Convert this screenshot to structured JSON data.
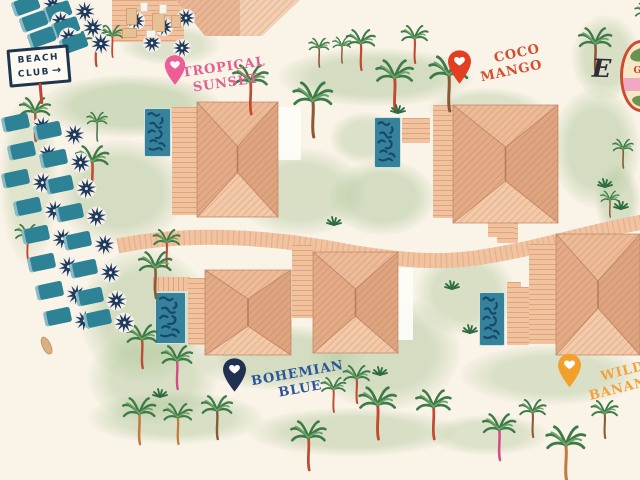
{
  "signs": {
    "beach_club": {
      "line1": "BEACH",
      "line2": "CLUB",
      "arrow": "→"
    },
    "compass_letter": "E"
  },
  "badge": {
    "visible_text": "GY"
  },
  "villas": [
    {
      "id": "tropical-sunset",
      "name": "Tropical Sunset",
      "label_line1": "TROPICAL",
      "label_line2": "SUNSET",
      "label_color": "#e2608f",
      "pin_color": "#ee5d95"
    },
    {
      "id": "coco-mango",
      "name": "Coco Mango",
      "label_line1": "COCO",
      "label_line2": "MANGO",
      "label_color": "#d74c2b",
      "pin_color": "#e33d22"
    },
    {
      "id": "bohemian-blue",
      "name": "Bohemian Blue",
      "label_line1": "BOHEMIAN",
      "label_line2": "BLUE",
      "label_color": "#2c549a",
      "pin_color": "#202f52"
    },
    {
      "id": "wild-banana",
      "name": "Wild Banana",
      "label_line1": "WILD",
      "label_line2": "BANANA",
      "label_color": "#f1a33e",
      "pin_color": "#f39f2c"
    }
  ],
  "colors": {
    "vars": {
      "bg": "#faf3e8",
      "grass": "#aec79a",
      "pool": "#35829a",
      "deck": "#f2c29e",
      "deck-line": "#dba67f",
      "walk": "#f1c3a0",
      "walk-line": "#dca47f",
      "lounger": "#2d8296",
      "parasol": "#1f3a5c",
      "sign-ink": "#1f3650",
      "post": "#c34432",
      "squig": "#17496f",
      "patio": "#fdfcf8"
    },
    "roof": {
      "top": "#edbb98",
      "bottom": "#f4caa8",
      "left": "#e4ab87",
      "right": "#dea580",
      "edge": "#c28a68",
      "ridge": "#b97f5e"
    },
    "trunks": {
      "r": "#c14a30",
      "b": "#8a5a35",
      "o": "#c07c3c",
      "p": "#d64a86",
      "g": "#4d7c4d"
    }
  },
  "map": {
    "blobs": [
      [
        40,
        75,
        180,
        62,
        0.55
      ],
      [
        278,
        48,
        195,
        58,
        0.5
      ],
      [
        428,
        88,
        115,
        42,
        0.4
      ],
      [
        572,
        15,
        68,
        85,
        0.45
      ],
      [
        55,
        140,
        130,
        105,
        0.5
      ],
      [
        235,
        148,
        130,
        88,
        0.45
      ],
      [
        330,
        160,
        105,
        75,
        0.5
      ],
      [
        552,
        88,
        88,
        120,
        0.5
      ],
      [
        595,
        165,
        45,
        70,
        0.45
      ],
      [
        80,
        248,
        130,
        135,
        0.5
      ],
      [
        88,
        330,
        130,
        95,
        0.45
      ],
      [
        195,
        325,
        170,
        65,
        0.5
      ],
      [
        310,
        295,
        150,
        115,
        0.5
      ],
      [
        415,
        250,
        100,
        85,
        0.45
      ],
      [
        460,
        345,
        185,
        60,
        0.42
      ],
      [
        540,
        235,
        100,
        62,
        0.45
      ],
      [
        248,
        408,
        210,
        48,
        0.45
      ],
      [
        88,
        392,
        175,
        52,
        0.45
      ],
      [
        330,
        112,
        70,
        52,
        0.4
      ],
      [
        120,
        25,
        100,
        40,
        0.38
      ],
      [
        0,
        95,
        58,
        170,
        0.35
      ],
      [
        428,
        415,
        120,
        40,
        0.38
      ]
    ],
    "decks": [
      [
        172,
        107,
        25,
        108,
        "h"
      ],
      [
        402,
        118,
        28,
        25,
        "h"
      ],
      [
        433,
        105,
        29,
        113,
        "h"
      ],
      [
        497,
        223,
        21,
        20,
        "h"
      ],
      [
        153,
        277,
        37,
        14,
        "v"
      ],
      [
        188,
        278,
        24,
        67,
        "h"
      ],
      [
        292,
        245,
        21,
        73,
        "h"
      ],
      [
        488,
        222,
        26,
        15,
        "h"
      ],
      [
        507,
        282,
        14,
        12,
        "h"
      ],
      [
        529,
        244,
        30,
        100,
        "h"
      ],
      [
        507,
        287,
        22,
        58,
        "h"
      ],
      [
        112,
        0,
        72,
        42,
        "h"
      ]
    ],
    "patios": [
      [
        278,
        107,
        23,
        53
      ],
      [
        397,
        268,
        16,
        72
      ]
    ],
    "pools": [
      [
        144,
        108,
        27,
        49
      ],
      [
        374,
        117,
        27,
        51
      ],
      [
        155,
        292,
        31,
        52
      ],
      [
        479,
        292,
        26,
        54
      ]
    ],
    "roofs": [
      [
        197,
        102,
        81,
        115
      ],
      [
        453,
        105,
        105,
        118
      ],
      [
        205,
        270,
        86,
        85
      ],
      [
        313,
        252,
        85,
        101
      ],
      [
        556,
        234,
        84,
        121
      ]
    ],
    "palms": [
      [
        80,
        52,
        0.7,
        "r"
      ],
      [
        100,
        46,
        0.55,
        "r"
      ],
      [
        18,
        126,
        0.75,
        "r"
      ],
      [
        86,
        131,
        0.5,
        "g"
      ],
      [
        75,
        176,
        0.8,
        "r"
      ],
      [
        14,
        247,
        0.6,
        "r"
      ],
      [
        232,
        97,
        0.85,
        "r"
      ],
      [
        292,
        118,
        0.95,
        "b"
      ],
      [
        308,
        57,
        0.5,
        "b"
      ],
      [
        332,
        54,
        0.45,
        "b"
      ],
      [
        345,
        56,
        0.7,
        "r"
      ],
      [
        400,
        50,
        0.65,
        "r"
      ],
      [
        375,
        94,
        0.9,
        "r"
      ],
      [
        428,
        92,
        0.95,
        "b"
      ],
      [
        578,
        58,
        0.8,
        "b"
      ],
      [
        634,
        24,
        0.55,
        "b"
      ],
      [
        152,
        254,
        0.65,
        "r"
      ],
      [
        138,
        282,
        0.8,
        "b"
      ],
      [
        125,
        353,
        0.75,
        "r"
      ],
      [
        160,
        374,
        0.75,
        "p"
      ],
      [
        122,
        428,
        0.8,
        "o"
      ],
      [
        162,
        430,
        0.7,
        "o"
      ],
      [
        200,
        424,
        0.75,
        "b"
      ],
      [
        290,
        453,
        0.85,
        "r"
      ],
      [
        320,
        400,
        0.6,
        "r"
      ],
      [
        358,
        421,
        0.9,
        "r"
      ],
      [
        342,
        390,
        0.65,
        "r"
      ],
      [
        415,
        422,
        0.85,
        "r"
      ],
      [
        482,
        444,
        0.8,
        "p"
      ],
      [
        518,
        424,
        0.65,
        "b"
      ],
      [
        545,
        462,
        0.95,
        "o"
      ],
      [
        590,
        425,
        0.65,
        "b"
      ],
      [
        612,
        158,
        0.5,
        "b"
      ],
      [
        600,
        208,
        0.45,
        "b"
      ]
    ],
    "tufts": [
      [
        597,
        178
      ],
      [
        613,
        200
      ],
      [
        444,
        280
      ],
      [
        462,
        324
      ],
      [
        372,
        366
      ],
      [
        152,
        388
      ],
      [
        390,
        104
      ],
      [
        326,
        216
      ]
    ],
    "loungers": [
      [
        12,
        -8,
        -20
      ],
      [
        44,
        -2,
        -20
      ],
      [
        20,
        8,
        -20
      ],
      [
        52,
        14,
        -20
      ],
      [
        28,
        24,
        -20
      ],
      [
        60,
        30,
        -20
      ],
      [
        2,
        110,
        -12
      ],
      [
        34,
        118,
        -12
      ],
      [
        8,
        138,
        -12
      ],
      [
        40,
        146,
        -12
      ],
      [
        2,
        166,
        -12
      ],
      [
        46,
        172,
        -12
      ],
      [
        14,
        194,
        -12
      ],
      [
        56,
        200,
        -12
      ],
      [
        22,
        222,
        -12
      ],
      [
        64,
        228,
        -12
      ],
      [
        28,
        250,
        -12
      ],
      [
        70,
        256,
        -12
      ],
      [
        36,
        278,
        -12
      ],
      [
        76,
        284,
        -12
      ],
      [
        44,
        304,
        -12
      ],
      [
        84,
        306,
        -12
      ]
    ],
    "furniture": [
      [
        "p",
        116,
        1
      ],
      [
        "p",
        144,
        7
      ],
      [
        "p",
        166,
        -2
      ],
      [
        "p",
        132,
        23
      ],
      [
        "p",
        162,
        28
      ],
      [
        "t",
        126,
        8,
        9,
        15
      ],
      [
        "t",
        152,
        13,
        11,
        17
      ],
      [
        "t",
        171,
        15,
        8,
        11
      ],
      [
        "t",
        122,
        28,
        13,
        8
      ],
      [
        "w",
        140,
        2,
        6,
        8
      ],
      [
        "w",
        159,
        4,
        6,
        8
      ],
      [
        "w",
        146,
        30,
        8,
        6
      ]
    ],
    "kayak": [
      42,
      336
    ]
  }
}
